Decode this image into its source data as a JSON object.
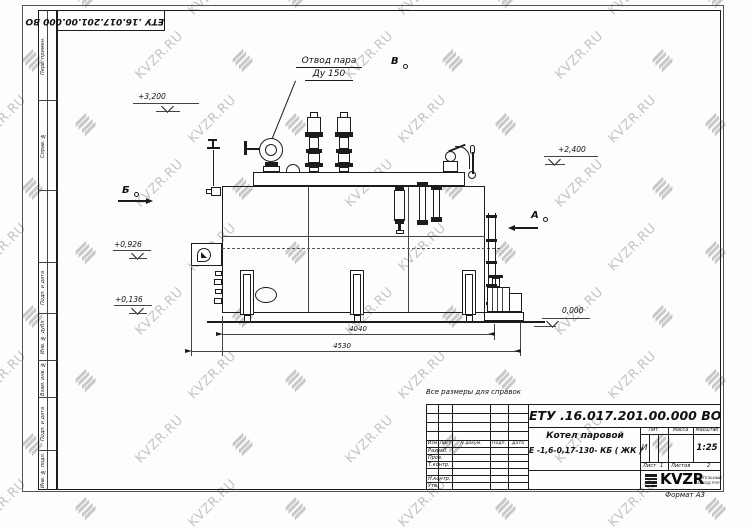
{
  "watermark": {
    "text": "KVZR.RU"
  },
  "stamp_top": {
    "doc_number": "ЕТУ .16.017.201.00.000  ВО"
  },
  "margin": {
    "labels": [
      "Перв. примен.",
      "Справ. №",
      "Подп. и дата",
      "Инв. № дубл.",
      "Взам. инв. №",
      "Подп. и дата",
      "Инв. № подл."
    ]
  },
  "drawing": {
    "callout": {
      "line1": "Отвод пара",
      "line2": "Ду 150"
    },
    "views": {
      "b": "Б",
      "v": "В",
      "a": "А"
    },
    "elevations": {
      "e3200": "+3,200",
      "e2400": "+2,400",
      "e0926": "+0,926",
      "e0136": "+0,136",
      "e0000": "0,000"
    },
    "dimensions": {
      "d1": "4040",
      "d2": "4530"
    },
    "note": "Все размеры для справок"
  },
  "title_block": {
    "doc_number": "ЕТУ .16.017.201.00.000  ВО",
    "product_line1": "Котел паровой",
    "product_line2": "Е -1,6-0,17-130- КБ ( ЖК )",
    "cols": {
      "izm": "Изм",
      "list": "Лист",
      "doc": "N докум.",
      "sign": "Подп.",
      "date": "Дата"
    },
    "rows": {
      "dev": "Разраб.",
      "check": "Пров.",
      "tcontr": "Т.контр.",
      "ncontr": "Н.контр.",
      "approve": "Утв."
    },
    "lit": {
      "label": "Лит.",
      "value": "И"
    },
    "mass": {
      "label": "Масса"
    },
    "scale": {
      "label": "Масштаб",
      "value": "1:25"
    },
    "sheet": {
      "label": "Лист",
      "value": "1"
    },
    "sheets": {
      "label": "Листов",
      "value": "2"
    },
    "logo": {
      "name": "KVZR",
      "sub1": "КОТЕЛЬНЫЙ",
      "sub2": "ЗАВОД РЭП"
    },
    "format": "Формат А3"
  }
}
